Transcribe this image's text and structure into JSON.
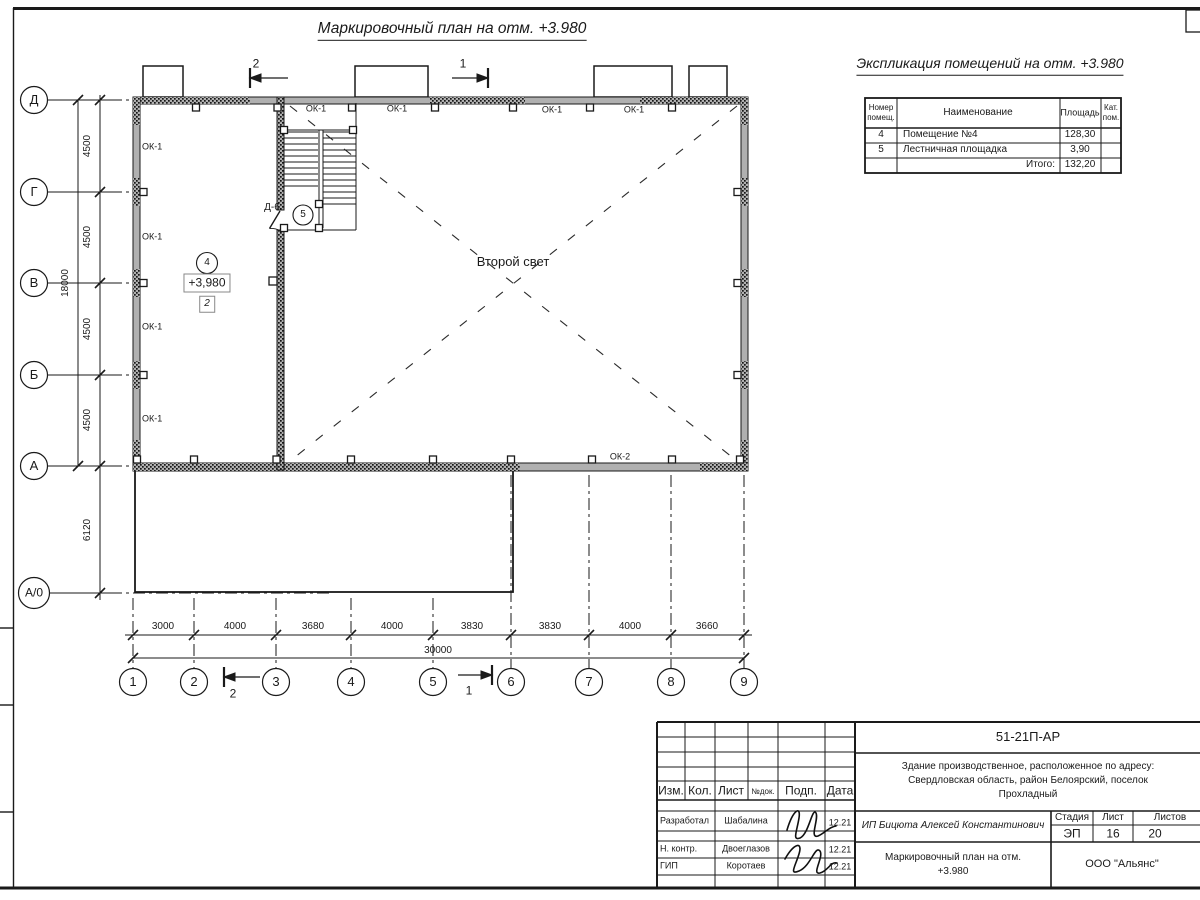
{
  "plan": {
    "title": "Маркировочный план на отм. +3.980",
    "axes_left": [
      "Д",
      "Г",
      "В",
      "Б",
      "А",
      "А/0"
    ],
    "axes_bottom": [
      "1",
      "2",
      "3",
      "4",
      "5",
      "6",
      "7",
      "8",
      "9"
    ],
    "dims_left": [
      "4500",
      "4500",
      "4500",
      "4500"
    ],
    "dim_left_total": "18000",
    "dim_left_lower": "6120",
    "dims_bottom": [
      "3000",
      "4000",
      "3680",
      "4000",
      "3830",
      "3830",
      "4000",
      "3660"
    ],
    "dim_bottom_total": "30000",
    "labels": {
      "ok1": "ОК-1",
      "ok2": "ОК-2",
      "door": "Д-6",
      "second_light": "Второй свет",
      "room4_num": "4",
      "room5_num": "5",
      "elevation": "+3,980",
      "type_mark": "2"
    },
    "sections": {
      "s1": "1",
      "s2": "2"
    }
  },
  "explication": {
    "title": "Экспликация помещений на отм. +3.980",
    "col_headers": [
      "Номер помещ.",
      "Наименование",
      "Площадь",
      "Кат. пом."
    ],
    "rows": [
      {
        "num": "4",
        "name": "Помещение №4",
        "area": "128,30",
        "cat": ""
      },
      {
        "num": "5",
        "name": "Лестничная площадка",
        "area": "3,90",
        "cat": ""
      }
    ],
    "total_label": "Итого:",
    "total_value": "132,20"
  },
  "titleblock": {
    "doc_number": "51-21П-АР",
    "project_lines": [
      "Здание производственное, расположенное по адресу:",
      "Свердловская область, район Белоярский, поселок",
      "Прохладный"
    ],
    "client": "ИП Бицюта Алексей Константинович",
    "sheet_title_lines": [
      "Маркировочный план на отм.",
      "+3.980"
    ],
    "company": "ООО \"Альянс\"",
    "headers": {
      "izm": "Изм.",
      "kol": "Кол.",
      "list": "Лист",
      "ndok": "№док.",
      "podp": "Подп.",
      "data": "Дата"
    },
    "stage_table": {
      "stage_label": "Стадия",
      "sheet_label": "Лист",
      "sheets_label": "Листов",
      "stage": "ЭП",
      "sheet": "16",
      "sheets": "20"
    },
    "roles": [
      {
        "role": "Разработал",
        "name": "Шабалина",
        "date": "12.21"
      },
      {
        "role": "Н. контр.",
        "name": "Двоеглазов",
        "date": "12.21"
      },
      {
        "role": "ГИП",
        "name": "Коротаев",
        "date": "12.21"
      }
    ]
  }
}
